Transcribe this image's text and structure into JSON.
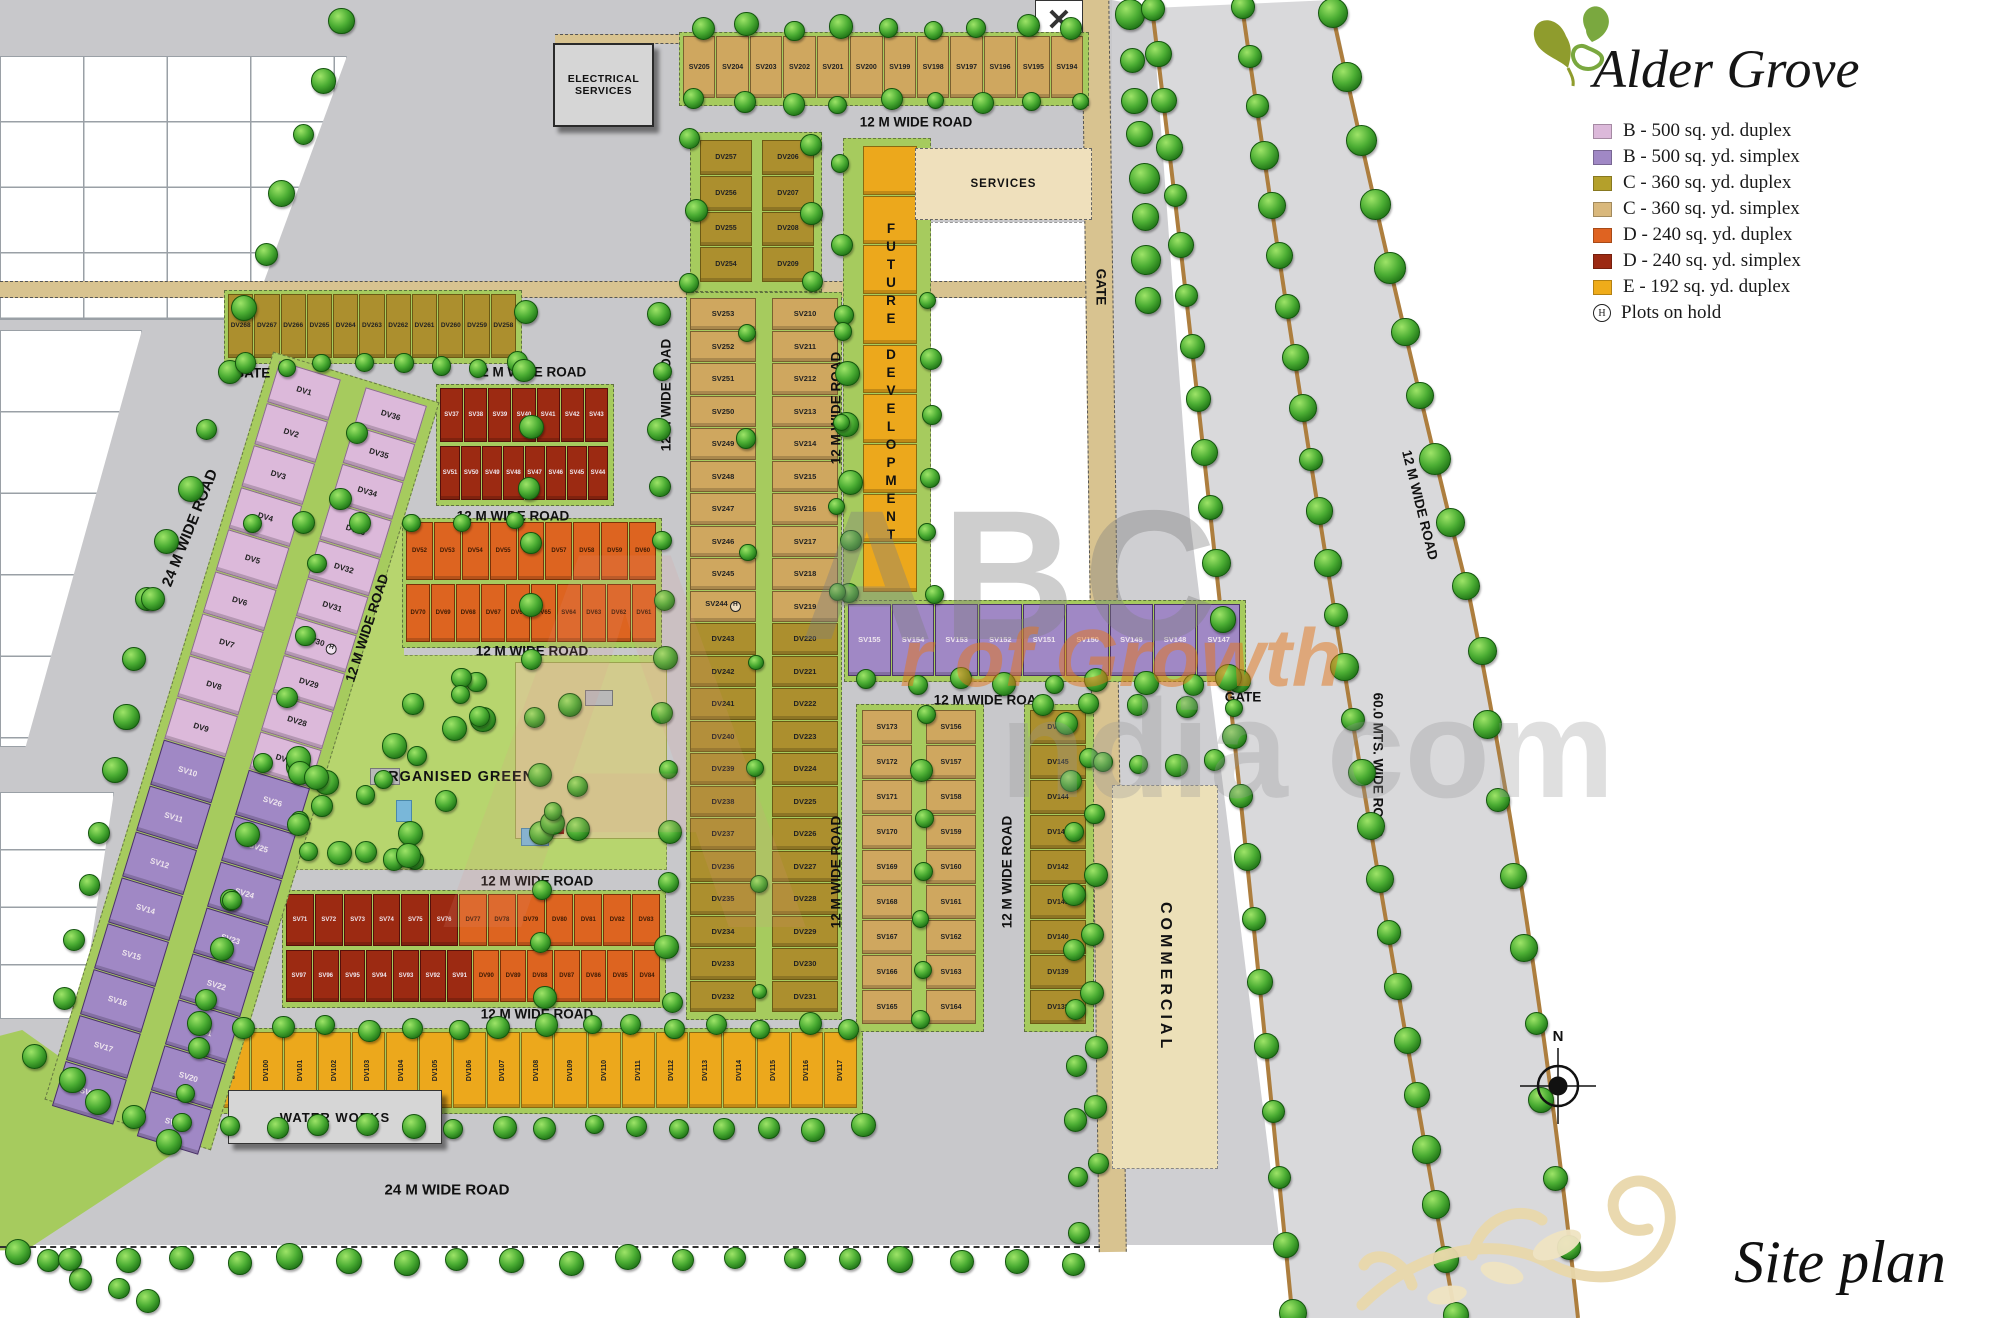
{
  "logo": {
    "title": "Alder Grove"
  },
  "caption": "Site plan",
  "compass_label": "N",
  "watermark": {
    "ghost": "A",
    "big": "ABC",
    "mid": "ndia com",
    "tagline": "r of Growth"
  },
  "legend": {
    "items": [
      {
        "label": "B - 500 sq. yd. duplex",
        "color": "#dcb9da"
      },
      {
        "label": "B - 500 sq. yd. simplex",
        "color": "#a088c5"
      },
      {
        "label": "C - 360 sq. yd. duplex",
        "color": "#b4a02b"
      },
      {
        "label": "C - 360 sq. yd. simplex",
        "color": "#d9b87c"
      },
      {
        "label": "D - 240 sq. yd. duplex",
        "color": "#df6321"
      },
      {
        "label": "D - 240 sq. yd. simplex",
        "color": "#9c2a13"
      },
      {
        "label": "E -  192 sq. yd. duplex",
        "color": "#efac1a"
      }
    ],
    "hold_symbol": "H",
    "hold_label": "Plots on hold"
  },
  "areas": {
    "electrical_line1": "ELECTRICAL",
    "electrical_line2": "SERVICES",
    "services": "SERVICES",
    "future": "FUTURE DEVELOPMENT",
    "organised_green": "ORGANISED GREEN",
    "commercial": "COMMERCIAL",
    "water_works": "WATER WORKS",
    "gate": "GATE"
  },
  "roads": {
    "r12": "12 M WIDE ROAD",
    "r24": "24 M  WIDE ROAD",
    "r60": "60.0 MTS. WIDE ROAD"
  },
  "holds": [
    "DV30",
    "SV244"
  ],
  "plots": {
    "top_row": [
      "SV205",
      "SV204",
      "SV203",
      "SV202",
      "SV201",
      "SV200",
      "SV199",
      "SV198",
      "SV197",
      "SV196",
      "SV195",
      "SV194"
    ],
    "dv268_row": [
      "DV268",
      "DV267",
      "DV266",
      "DV265",
      "DV264",
      "DV263",
      "DV262",
      "DV261",
      "DV260",
      "DV259",
      "DV258"
    ],
    "dv257_col": [
      "DV257",
      "DV256",
      "DV255",
      "DV254"
    ],
    "dv206_col": [
      "DV206",
      "DV207",
      "DV208",
      "DV209"
    ],
    "central_left": [
      "SV253",
      "SV252",
      "SV251",
      "SV250",
      "SV249",
      "SV248",
      "SV247",
      "SV246",
      "SV245",
      "SV244",
      "DV243",
      "DV242",
      "DV241",
      "DV240",
      "DV239",
      "DV238",
      "DV237",
      "DV236",
      "DV235",
      "DV234",
      "DV233",
      "DV232"
    ],
    "central_right": [
      "SV210",
      "SV211",
      "SV212",
      "SV213",
      "SV214",
      "SV215",
      "SV216",
      "SV217",
      "SV218",
      "SV219",
      "DV220",
      "DV221",
      "DV222",
      "DV223",
      "DV224",
      "DV225",
      "DV226",
      "DV227",
      "DV228",
      "DV229",
      "DV230",
      "DV231"
    ],
    "pink_left": [
      "DV1",
      "DV2",
      "DV3",
      "DV4",
      "DV5",
      "DV6",
      "DV7",
      "DV8",
      "DV9"
    ],
    "pink_right": [
      "DV36",
      "DV35",
      "DV34",
      "DV33",
      "DV32",
      "DV31",
      "DV30",
      "DV29",
      "DV28",
      "DV27"
    ],
    "purple_left": [
      "SV10",
      "SV11",
      "SV12",
      "SV14",
      "SV15",
      "SV16",
      "SV17",
      "SV18"
    ],
    "purple_right": [
      "SV26",
      "SV25",
      "SV24",
      "SV23",
      "SV22",
      "SV21",
      "SV20",
      "SV19"
    ],
    "red_upper_r1": [
      "SV37",
      "SV38",
      "SV39",
      "SV40",
      "SV41",
      "SV42",
      "SV43"
    ],
    "red_upper_r2": [
      "SV51",
      "SV50",
      "SV49",
      "SV48",
      "SV47",
      "SV46",
      "SV45",
      "SV44"
    ],
    "orange_r1": [
      "DV52",
      "DV53",
      "DV54",
      "DV55",
      "DV56",
      "DV57",
      "DV58",
      "DV59",
      "DV60"
    ],
    "orange_r2": [
      "DV70",
      "DV69",
      "DV68",
      "DV67",
      "DV66",
      "DV65",
      "SV64",
      "DV63",
      "DV62",
      "DV61"
    ],
    "mixed_r1_red": [
      "SV71",
      "SV72",
      "SV73",
      "SV74",
      "SV75",
      "SV76"
    ],
    "mixed_r1_orange": [
      "DV77",
      "DV78",
      "DV79",
      "DV80",
      "DV81",
      "DV82",
      "DV83"
    ],
    "mixed_r2_red": [
      "SV97",
      "SV96",
      "SV95",
      "SV94",
      "SV93",
      "SV92",
      "SV91"
    ],
    "mixed_r2_orange": [
      "DV90",
      "DV89",
      "DV88",
      "DV87",
      "DV86",
      "DV85",
      "DV84"
    ],
    "yellow_row": [
      "DV98",
      "DV99",
      "DV100",
      "DV101",
      "DV102",
      "DV103",
      "DV104",
      "DV105",
      "DV106",
      "DV107",
      "DV108",
      "DV109",
      "DV110",
      "DV111",
      "DV112",
      "DV113",
      "DV114",
      "DV115",
      "DV116",
      "DV117"
    ],
    "purple_row": [
      "SV155",
      "SV154",
      "SV153",
      "SV152",
      "SV151",
      "SV150",
      "SV149",
      "SV148",
      "SV147"
    ],
    "rc_col1": [
      "SV173",
      "SV172",
      "SV171",
      "SV170",
      "SV169",
      "SV168",
      "SV167",
      "SV166",
      "SV165"
    ],
    "rc_col2": [
      "SV156",
      "SV157",
      "SV158",
      "SV159",
      "SV160",
      "SV161",
      "SV162",
      "SV163",
      "SV164"
    ],
    "rc_col3": [
      "DV146",
      "DV145",
      "DV144",
      "DV143",
      "DV142",
      "DV141",
      "DV140",
      "DV139",
      "DV138"
    ]
  }
}
